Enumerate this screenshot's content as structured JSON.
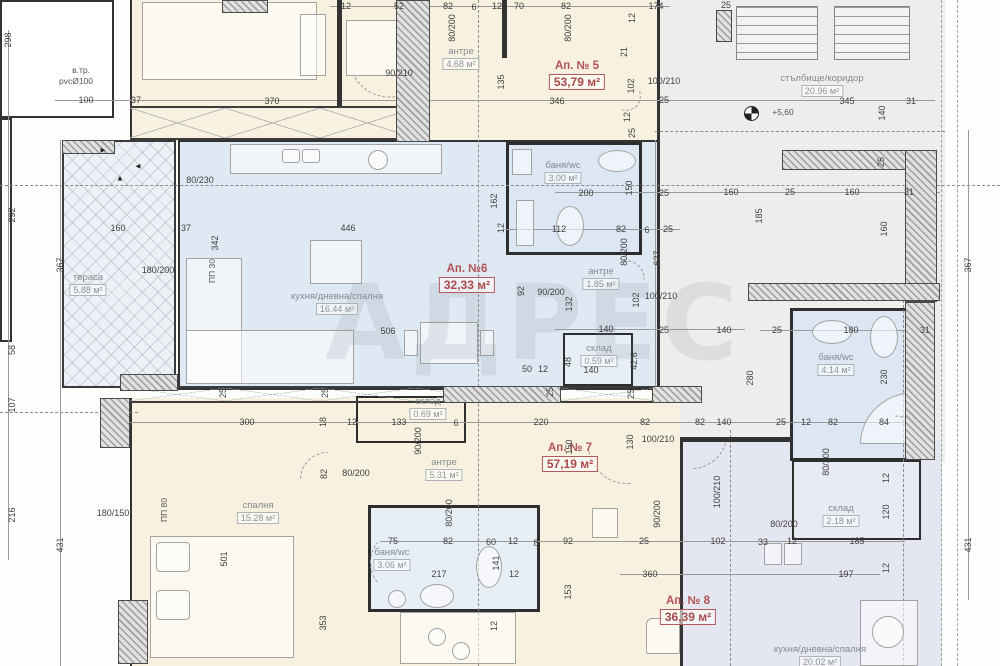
{
  "watermark": {
    "text": "АДРЕС"
  },
  "apartments": [
    {
      "id": "ap5",
      "label": "Ап. № 5",
      "area": "53,79 м²",
      "x": 577,
      "y": 64,
      "ax": 577,
      "ay": 86
    },
    {
      "id": "ap6",
      "label": "Ап. №6",
      "area": "32,33 м²",
      "x": 469,
      "y": 268,
      "ax": 467,
      "ay": 288
    },
    {
      "id": "ap7",
      "label": "Ап. № 7",
      "area": "57,19 м²",
      "x": 576,
      "y": 448,
      "ax": 570,
      "ay": 466
    },
    {
      "id": "ap8",
      "label": "Ап. № 8",
      "area": "36,39 м²",
      "x": 686,
      "y": 600,
      "ax": 688,
      "ay": 620
    }
  ],
  "rooms": [
    {
      "id": "terrace",
      "name": "тераса",
      "area": "5.88 м²",
      "x": 88,
      "y": 284
    },
    {
      "id": "antre5",
      "name": "антре",
      "area": "4.68 м²",
      "x": 461,
      "y": 58
    },
    {
      "id": "stair",
      "name": "стълбище/коридор",
      "area": "20.96 м²",
      "x": 822,
      "y": 85
    },
    {
      "id": "bath5",
      "name": "баня/wc",
      "area": "3.00 м²",
      "x": 563,
      "y": 172
    },
    {
      "id": "kitchen6",
      "name": "кухня/дневна/спалня",
      "area": "16.44 м²",
      "x": 337,
      "y": 303
    },
    {
      "id": "antre6",
      "name": "антре",
      "area": "1.85 м²",
      "x": 601,
      "y": 278
    },
    {
      "id": "sklad6",
      "name": "склад",
      "area": "0.59 м²",
      "x": 599,
      "y": 355
    },
    {
      "id": "bath8",
      "name": "баня/wc",
      "area": "4.14 м²",
      "x": 836,
      "y": 364
    },
    {
      "id": "sklad7",
      "name": "склад",
      "area": "0.69 м²",
      "x": 428,
      "y": 408
    },
    {
      "id": "antre7",
      "name": "антре",
      "area": "5.31 м²",
      "x": 444,
      "y": 469
    },
    {
      "id": "bedroom7",
      "name": "спалня",
      "area": "15.28 м²",
      "x": 258,
      "y": 512
    },
    {
      "id": "bath7",
      "name": "баня/wc",
      "area": "3.06 м²",
      "x": 392,
      "y": 559
    },
    {
      "id": "sklad8",
      "name": "склад",
      "area": "2.18 м²",
      "x": 841,
      "y": 515
    },
    {
      "id": "kitchen8",
      "name": "кухня/дневна/спалня",
      "area": "20.02 м²",
      "x": 820,
      "y": 656
    }
  ],
  "annotations": [
    {
      "t": "в.тр.",
      "x": 81,
      "y": 70,
      "cls": "note"
    },
    {
      "t": "pvcØ100",
      "x": 76,
      "y": 81,
      "cls": "note"
    },
    {
      "t": "+5,60",
      "x": 783,
      "y": 112,
      "cls": "note"
    },
    {
      "t": "ПП 30",
      "x": 212,
      "y": 271,
      "r": 1,
      "cls": "note"
    },
    {
      "t": "ПП 80",
      "x": 164,
      "y": 510,
      "r": 1,
      "cls": "note"
    },
    {
      "t": "►",
      "x": 103,
      "y": 150,
      "cls": "arrow"
    },
    {
      "t": "▲",
      "x": 120,
      "y": 178,
      "cls": "arrow"
    },
    {
      "t": "◄",
      "x": 138,
      "y": 166,
      "cls": "arrow"
    }
  ],
  "dimensions": [
    {
      "t": "12",
      "x": 346,
      "y": 6
    },
    {
      "t": "52",
      "x": 399,
      "y": 6
    },
    {
      "t": "82",
      "x": 448,
      "y": 6
    },
    {
      "t": "6",
      "x": 474,
      "y": 7
    },
    {
      "t": "12",
      "x": 497,
      "y": 6
    },
    {
      "t": "70",
      "x": 519,
      "y": 6
    },
    {
      "t": "82",
      "x": 566,
      "y": 6
    },
    {
      "t": "174",
      "x": 656,
      "y": 6
    },
    {
      "t": "12",
      "x": 632,
      "y": 18,
      "r": 1
    },
    {
      "t": "25",
      "x": 726,
      "y": 5
    },
    {
      "t": "80/200",
      "x": 452,
      "y": 28,
      "r": 1
    },
    {
      "t": "80/200",
      "x": 568,
      "y": 28,
      "r": 1
    },
    {
      "t": "90/210",
      "x": 399,
      "y": 73
    },
    {
      "t": "135",
      "x": 501,
      "y": 82,
      "r": 1
    },
    {
      "t": "346",
      "x": 557,
      "y": 101
    },
    {
      "t": "21",
      "x": 624,
      "y": 52,
      "r": 1
    },
    {
      "t": "102",
      "x": 631,
      "y": 86,
      "r": 1
    },
    {
      "t": "100/210",
      "x": 664,
      "y": 81
    },
    {
      "t": "25",
      "x": 664,
      "y": 100
    },
    {
      "t": "370",
      "x": 272,
      "y": 101
    },
    {
      "t": "37",
      "x": 136,
      "y": 100
    },
    {
      "t": "100",
      "x": 86,
      "y": 100
    },
    {
      "t": "345",
      "x": 847,
      "y": 101
    },
    {
      "t": "31",
      "x": 911,
      "y": 101
    },
    {
      "t": "140",
      "x": 882,
      "y": 113,
      "r": 1
    },
    {
      "t": "12",
      "x": 627,
      "y": 117,
      "r": 1
    },
    {
      "t": "25",
      "x": 632,
      "y": 133,
      "r": 1
    },
    {
      "t": "25",
      "x": 881,
      "y": 162,
      "r": 1
    },
    {
      "t": "80/230",
      "x": 200,
      "y": 180
    },
    {
      "t": "160",
      "x": 118,
      "y": 228
    },
    {
      "t": "37",
      "x": 186,
      "y": 228
    },
    {
      "t": "342",
      "x": 215,
      "y": 243,
      "r": 1
    },
    {
      "t": "446",
      "x": 348,
      "y": 228
    },
    {
      "t": "162",
      "x": 494,
      "y": 201,
      "r": 1
    },
    {
      "t": "12",
      "x": 501,
      "y": 228,
      "r": 1
    },
    {
      "t": "200",
      "x": 586,
      "y": 193
    },
    {
      "t": "150",
      "x": 629,
      "y": 188,
      "r": 1
    },
    {
      "t": "25",
      "x": 664,
      "y": 193
    },
    {
      "t": "160",
      "x": 731,
      "y": 192
    },
    {
      "t": "25",
      "x": 790,
      "y": 192
    },
    {
      "t": "160",
      "x": 852,
      "y": 192
    },
    {
      "t": "31",
      "x": 909,
      "y": 192
    },
    {
      "t": "185",
      "x": 759,
      "y": 216,
      "r": 1
    },
    {
      "t": "160",
      "x": 884,
      "y": 229,
      "r": 1
    },
    {
      "t": "112",
      "x": 559,
      "y": 229
    },
    {
      "t": "82",
      "x": 621,
      "y": 229
    },
    {
      "t": "6",
      "x": 647,
      "y": 230
    },
    {
      "t": "25",
      "x": 668,
      "y": 229
    },
    {
      "t": "627",
      "x": 657,
      "y": 258,
      "r": 1
    },
    {
      "t": "92",
      "x": 521,
      "y": 291,
      "r": 1
    },
    {
      "t": "180/200",
      "x": 158,
      "y": 270
    },
    {
      "t": "90/200",
      "x": 551,
      "y": 292
    },
    {
      "t": "132",
      "x": 569,
      "y": 304,
      "r": 1
    },
    {
      "t": "102",
      "x": 636,
      "y": 300,
      "r": 1
    },
    {
      "t": "100/210",
      "x": 661,
      "y": 296
    },
    {
      "t": "80/200",
      "x": 624,
      "y": 252,
      "r": 1
    },
    {
      "t": "506",
      "x": 388,
      "y": 331
    },
    {
      "t": "140",
      "x": 606,
      "y": 329
    },
    {
      "t": "25",
      "x": 664,
      "y": 330
    },
    {
      "t": "140",
      "x": 724,
      "y": 330
    },
    {
      "t": "25",
      "x": 777,
      "y": 330
    },
    {
      "t": "180",
      "x": 851,
      "y": 330
    },
    {
      "t": "31",
      "x": 925,
      "y": 330
    },
    {
      "t": "280",
      "x": 750,
      "y": 378,
      "r": 1
    },
    {
      "t": "230",
      "x": 884,
      "y": 377,
      "r": 1
    },
    {
      "t": "48",
      "x": 568,
      "y": 362,
      "r": 1
    },
    {
      "t": "140",
      "x": 591,
      "y": 370
    },
    {
      "t": "42.6",
      "x": 634,
      "y": 361,
      "r": 1
    },
    {
      "t": "50",
      "x": 527,
      "y": 369
    },
    {
      "t": "12",
      "x": 543,
      "y": 369
    },
    {
      "t": "25",
      "x": 550,
      "y": 392,
      "r": 1
    },
    {
      "t": "25",
      "x": 631,
      "y": 394,
      "r": 1
    },
    {
      "t": "25",
      "x": 223,
      "y": 393,
      "r": 1
    },
    {
      "t": "25",
      "x": 325,
      "y": 393,
      "r": 1
    },
    {
      "t": "300",
      "x": 247,
      "y": 422
    },
    {
      "t": "18",
      "x": 323,
      "y": 422,
      "r": 1
    },
    {
      "t": "12",
      "x": 352,
      "y": 422
    },
    {
      "t": "133",
      "x": 399,
      "y": 422
    },
    {
      "t": "6",
      "x": 456,
      "y": 423
    },
    {
      "t": "220",
      "x": 541,
      "y": 422
    },
    {
      "t": "82",
      "x": 645,
      "y": 422
    },
    {
      "t": "82",
      "x": 700,
      "y": 422
    },
    {
      "t": "140",
      "x": 724,
      "y": 422
    },
    {
      "t": "25",
      "x": 781,
      "y": 422
    },
    {
      "t": "12",
      "x": 806,
      "y": 422
    },
    {
      "t": "82",
      "x": 833,
      "y": 422
    },
    {
      "t": "84",
      "x": 884,
      "y": 422
    },
    {
      "t": "130",
      "x": 630,
      "y": 442,
      "r": 1
    },
    {
      "t": "100/210",
      "x": 658,
      "y": 439
    },
    {
      "t": "100/210",
      "x": 717,
      "y": 492,
      "r": 1
    },
    {
      "t": "90/200",
      "x": 418,
      "y": 441,
      "r": 1
    },
    {
      "t": "80/200",
      "x": 356,
      "y": 473
    },
    {
      "t": "150",
      "x": 569,
      "y": 447,
      "r": 1
    },
    {
      "t": "82",
      "x": 324,
      "y": 474,
      "r": 1
    },
    {
      "t": "180/150",
      "x": 113,
      "y": 513
    },
    {
      "t": "501",
      "x": 224,
      "y": 559,
      "r": 1
    },
    {
      "t": "353",
      "x": 323,
      "y": 623,
      "r": 1
    },
    {
      "t": "75",
      "x": 393,
      "y": 541
    },
    {
      "t": "82",
      "x": 448,
      "y": 541
    },
    {
      "t": "60",
      "x": 491,
      "y": 542
    },
    {
      "t": "12",
      "x": 513,
      "y": 541
    },
    {
      "t": "8",
      "x": 536,
      "y": 543
    },
    {
      "t": "92",
      "x": 568,
      "y": 541
    },
    {
      "t": "217",
      "x": 439,
      "y": 574
    },
    {
      "t": "141",
      "x": 496,
      "y": 563,
      "r": 1
    },
    {
      "t": "12",
      "x": 514,
      "y": 574
    },
    {
      "t": "80/200",
      "x": 449,
      "y": 513,
      "r": 1
    },
    {
      "t": "90/200",
      "x": 657,
      "y": 514,
      "r": 1
    },
    {
      "t": "153",
      "x": 568,
      "y": 592,
      "r": 1
    },
    {
      "t": "12",
      "x": 494,
      "y": 626,
      "r": 1
    },
    {
      "t": "360",
      "x": 650,
      "y": 574
    },
    {
      "t": "25",
      "x": 644,
      "y": 541
    },
    {
      "t": "102",
      "x": 718,
      "y": 541
    },
    {
      "t": "33",
      "x": 763,
      "y": 542
    },
    {
      "t": "12",
      "x": 792,
      "y": 541
    },
    {
      "t": "185",
      "x": 857,
      "y": 541
    },
    {
      "t": "197",
      "x": 846,
      "y": 574
    },
    {
      "t": "120",
      "x": 886,
      "y": 512,
      "r": 1
    },
    {
      "t": "12",
      "x": 886,
      "y": 478,
      "r": 1
    },
    {
      "t": "12",
      "x": 886,
      "y": 568,
      "r": 1
    },
    {
      "t": "80/200",
      "x": 826,
      "y": 462,
      "r": 1
    },
    {
      "t": "80/200",
      "x": 784,
      "y": 524
    },
    {
      "t": "298",
      "x": 8,
      "y": 40,
      "r": 1
    },
    {
      "t": "292",
      "x": 12,
      "y": 215,
      "r": 1
    },
    {
      "t": "367",
      "x": 60,
      "y": 265,
      "r": 1
    },
    {
      "t": "58",
      "x": 12,
      "y": 350,
      "r": 1
    },
    {
      "t": "107",
      "x": 12,
      "y": 405,
      "r": 1
    },
    {
      "t": "216",
      "x": 12,
      "y": 515,
      "r": 1
    },
    {
      "t": "431",
      "x": 60,
      "y": 545,
      "r": 1
    },
    {
      "t": "367",
      "x": 968,
      "y": 265,
      "r": 1
    },
    {
      "t": "431",
      "x": 968,
      "y": 545,
      "r": 1
    }
  ]
}
